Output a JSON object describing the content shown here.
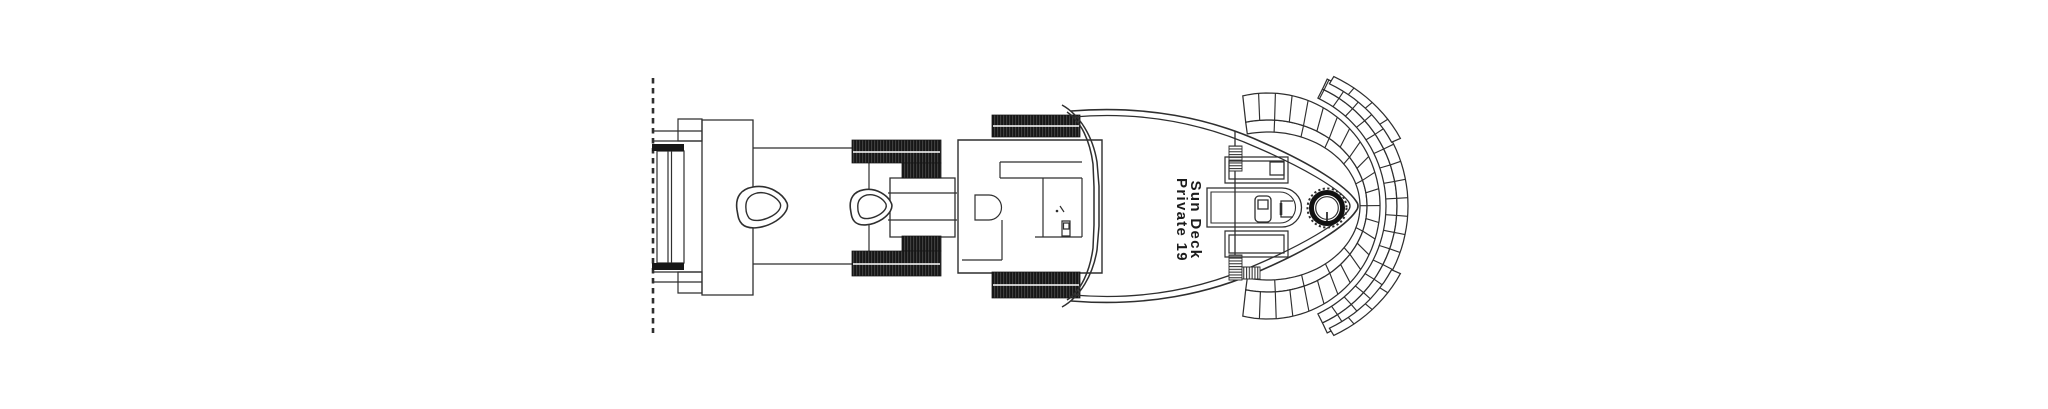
{
  "deck_plan": {
    "label_line1": "Sun Deck",
    "label_line2": "Private 19",
    "colors": {
      "line": "#2f2f2f",
      "black_fill": "#161616",
      "background": "#ffffff"
    }
  }
}
